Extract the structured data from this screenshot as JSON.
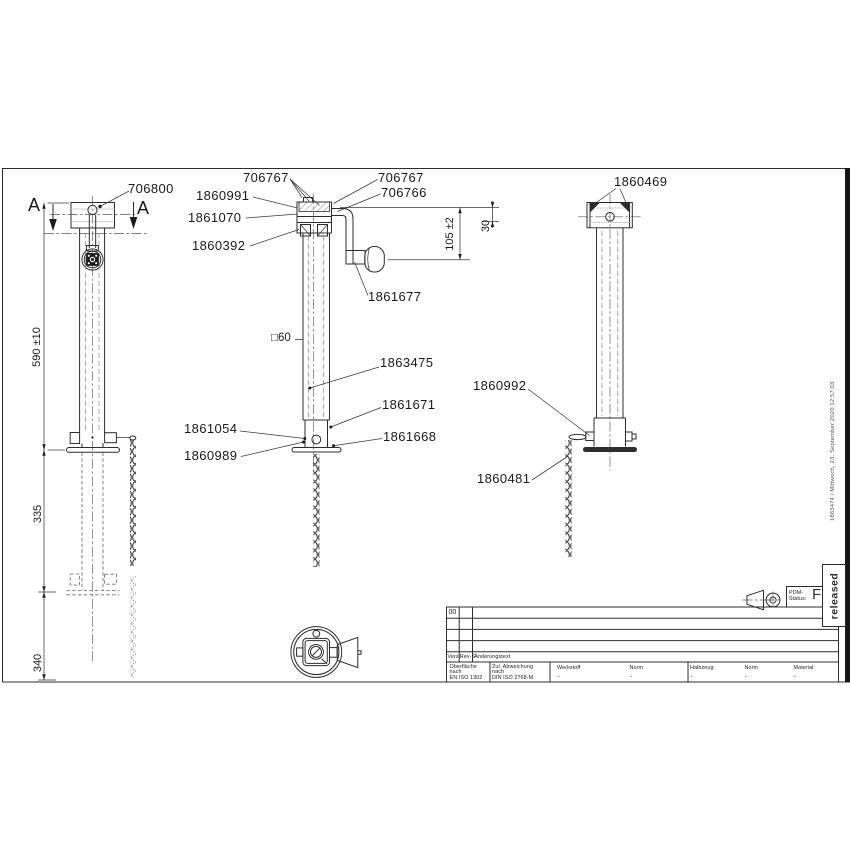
{
  "colors": {
    "line": "#2d2d2d",
    "text": "#1a1a1a",
    "stamp": "#2b2b2b"
  },
  "callouts": {
    "n706800": "706800",
    "n706767_left": "706767",
    "n1860991": "1860991",
    "n1861070": "1861070",
    "n1860392": "1860392",
    "n706767_right": "706767",
    "n706766": "706766",
    "n1861677": "1861677",
    "tube_profile": "□60",
    "n1863475": "1863475",
    "n1861671": "1861671",
    "n1861054": "1861054",
    "n1860989": "1860989",
    "n1861668": "1861668",
    "n1860469": "1860469",
    "n1860992": "1860992",
    "n1860481": "1860481"
  },
  "dimensions": {
    "overall_height": "590 ±10",
    "stroke_upper": "335",
    "stroke_lower": "340",
    "crank_height": "105 ±2",
    "crank_top": "30"
  },
  "section_marks": {
    "left": "A",
    "right": "A"
  },
  "title_block": {
    "rev_table": {
      "first_cell": "00",
      "col_vers": "Vers.",
      "col_rev": "Rev-S",
      "col_text": "Änderungstext"
    },
    "surface": {
      "l1": "Oberfläche",
      "l2": "nach",
      "std": "EN ISO 1302"
    },
    "tolerance": {
      "l1": "Zul. Abweichung",
      "l2": "nach",
      "std": "DIN ISO 2768-M"
    },
    "fields": [
      {
        "label": "Werkstoff",
        "value": "-"
      },
      {
        "label": "Norm",
        "value": "-"
      },
      {
        "label": "Halbzeug",
        "value": "-"
      },
      {
        "label": "Norm",
        "value": "-"
      },
      {
        "label": "Material:",
        "value": "-"
      }
    ],
    "pdm_label_1": "PDM-",
    "pdm_label_2": "Status:",
    "pdm_value": "F",
    "stamp": "released"
  },
  "edge_note": "1863474 / Mittwoch, 23. September 2020 12:57:03"
}
